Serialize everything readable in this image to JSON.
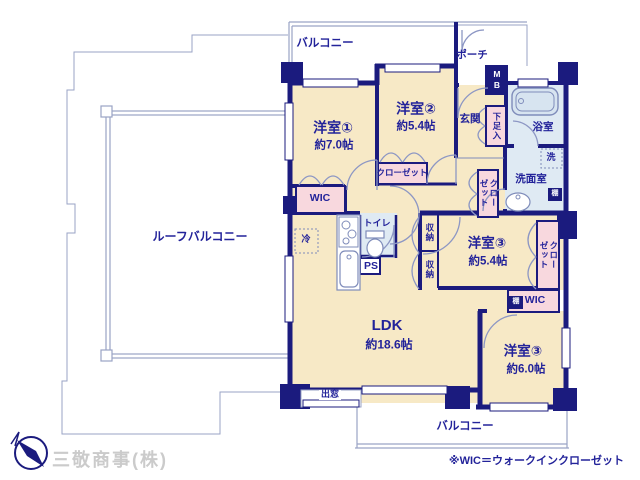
{
  "colors": {
    "wall": "#1b1b7e",
    "room_fill": "#f7e9c6",
    "closet_fill": "#f8d8de",
    "wet_fill": "#dfeaf3",
    "outline": "#9aa3c5",
    "fixture": "#7f8cba",
    "text": "#23239a",
    "footer_text": "#cbcbcb"
  },
  "rooms": {
    "room1": {
      "name": "洋室①",
      "size": "約7.0帖"
    },
    "room2": {
      "name": "洋室②",
      "size": "約5.4帖"
    },
    "room3a": {
      "name": "洋室③",
      "size": "約5.4帖"
    },
    "room3b": {
      "name": "洋室③",
      "size": "約6.0帖"
    },
    "ldk": {
      "name": "LDK",
      "size": "約18.6帖"
    }
  },
  "labels": {
    "roof_balcony": "ルーフバルコニー",
    "balcony_top": "バルコニー",
    "balcony_bottom": "バルコニー",
    "porch": "ポーチ",
    "entrance": "玄関",
    "shoe_box": "下足入",
    "meter_box": "MB",
    "bath": "浴室",
    "washer": "洗",
    "washroom": "洗面室",
    "shelf_a": "棚",
    "shelf_b": "棚",
    "closet_hall": "クローゼット",
    "closet_room2": "クローゼット",
    "closet_room3": "クローゼット",
    "storage_top": "収納",
    "storage_bottom": "収納",
    "toilet": "トイレ",
    "pipe_space": "PS",
    "fridge": "冷",
    "bay_window": "出窓",
    "wic_room1": "WIC",
    "wic_room3": "WIC"
  },
  "footer": {
    "company": "三敬商事(株)",
    "note": "※WIC＝ウォークインクローゼット"
  }
}
